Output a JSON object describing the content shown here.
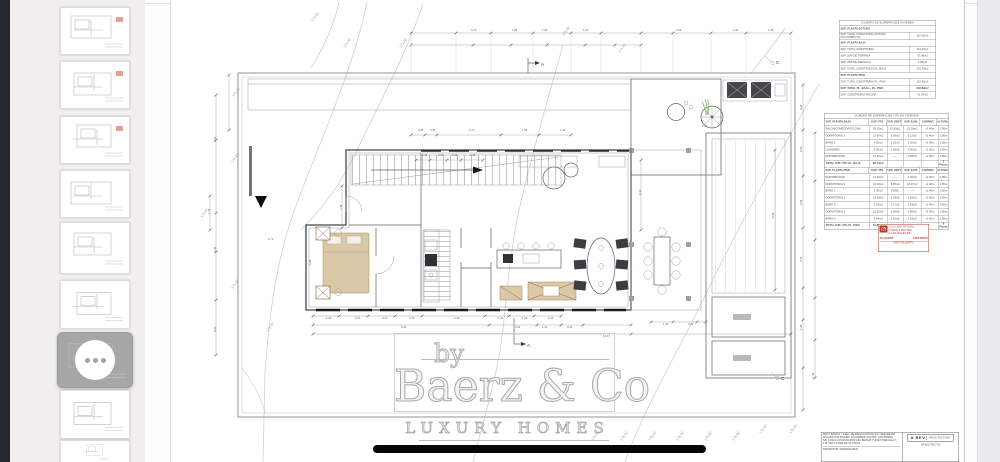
{
  "sidebar": {
    "pages": [
      {
        "selected": false
      },
      {
        "selected": false
      },
      {
        "selected": false
      },
      {
        "selected": false
      },
      {
        "selected": false
      },
      {
        "selected": false
      },
      {
        "selected": true
      },
      {
        "selected": false
      },
      {
        "selected": false
      }
    ]
  },
  "watermark": {
    "by": "by",
    "brand": "Baerz & Co",
    "tagline": "LUXURY HOMES"
  },
  "tables": {
    "superficies": {
      "title": "CUADRO DE SUPERFICIES VIVIENDA",
      "rows": [
        {
          "type": "head",
          "label": "SUP. PLANTA SOTANO"
        },
        {
          "type": "row",
          "label": "SUP. TOTAL CONSTRUIDA SOTANO\n(NO COMPUTA)",
          "value": "110.50m2"
        },
        {
          "type": "head",
          "label": "SUP. PLANTA BAJA"
        },
        {
          "type": "row",
          "label": "SUP. TOTAL CONSTRUIDA",
          "value": "113.40m2"
        },
        {
          "type": "row",
          "label": "SUP. 50% DE TERRAZA",
          "value": "17.06m2"
        },
        {
          "type": "row",
          "label": "SUP. 25% DE PERGOLA",
          "value": "1.88m2"
        },
        {
          "type": "row",
          "label": "SUP. TOTAL CONSTRUIDA PL. BAJA",
          "value": "132.34m2"
        },
        {
          "type": "head",
          "label": "SUP. PLANTA PISO"
        },
        {
          "type": "row",
          "label": "SUP. TOTAL CONSTRUIDA PL. PISO",
          "value": "110.55m2"
        },
        {
          "type": "row",
          "label": "SUP. TOTAL PL. BAJA + PL. PISO",
          "value": "242.89m2",
          "bold": true
        },
        {
          "type": "row",
          "label": "SUP. CONSTRUIDA PISCINA",
          "value": "41.78m2"
        }
      ]
    },
    "utiles": {
      "title": "CUADRO DE SUPERFICIES ÚTILES VIVIENDA",
      "sections": [
        {
          "header": [
            "SUP. PLANTA BAJA",
            "SUP. ÚTIL",
            "SUP. VENT",
            "SUP. ILUM",
            "CARPINT.",
            "ALTURA"
          ],
          "rows": [
            [
              "SALON/COMEDOR/COCINA",
              "55.15m2",
              "13.83m2",
              "23.05m2",
              "+2.40m",
              "2.85m"
            ],
            [
              "DORMITORIO 1",
              "12.87m2",
              "3.06m2",
              "6.12m2",
              "+2.40m",
              "2.85m"
            ],
            [
              "BAÑO 1",
              "4.25m2",
              "1.02m2",
              "1.02m2",
              "+1.40m",
              "2.85m"
            ],
            [
              "LAVADERO",
              "5.35m2",
              "2.45m2",
              "4.90m2",
              "+1.05m",
              "2.85m"
            ],
            [
              "DISTRIBUIDOR",
              "10.52m2",
              "-----",
              "4.06m2",
              "+1.05m",
              "2.85m"
            ]
          ],
          "total": {
            "label": "TOTAL SUP. ÚTIL PL. BAJA",
            "value": "88.14m2",
            "note": "3 Piezas"
          }
        },
        {
          "header": [
            "SUP. PLANTA PISO",
            "SUP. ÚTIL",
            "SUP. VENT",
            "SUP. ILUM",
            "CARPINT.",
            "ALTURA"
          ],
          "rows": [
            [
              "DISTRIBUIDOR",
              "12.40m2",
              "------",
              "4.36m2",
              "+1.20m",
              "2.85m"
            ],
            [
              "DORMITORIO 2",
              "24.36m2",
              "8.05m2",
              "16.07m2",
              "+2.40m",
              "2.85m"
            ],
            [
              "BAÑO 2",
              "5.36m2",
              "FORZ.",
              "------",
              "+1.40m",
              "2.85m"
            ],
            [
              "DORMITORIO 3",
              "13.39m2",
              "2.34m2",
              "3.84m2",
              "+2.40m",
              "2.85m"
            ],
            [
              "BAÑO 3",
              "5.03m2",
              "1.17m2",
              "1.63m2",
              "+1.40m",
              "2.85m"
            ],
            [
              "DORMITORIO 4",
              "16.25m2",
              "2.46m2",
              "4.85m2",
              "+2.40m",
              "2.85m"
            ],
            [
              "BAÑO 4",
              "5.04m2",
              "1.15m2",
              "1.63m2",
              "+1.40m",
              "2.85m"
            ]
          ],
          "total": {
            "label": "TOTAL SUP. ÚTIL PL. PISO",
            "value": "81.83m2",
            "note": "6 Piezas"
          }
        }
      ]
    }
  },
  "stamp": {
    "org_line1": "COL·LEGI OFICIAL",
    "org_line2": "D'ARQUITECTES",
    "org_line3": "ILLES BALEARS",
    "date": "13.10.2023",
    "number": "12614/2023",
    "footer": "VISAT TELEMÀTIC"
  },
  "title_block": {
    "lines": [
      "PROY. BASICO Y EJEC. DE AMPLIACION DE VIV. UNIFAMILIAR",
      "AISLADA CON PISCINA, EN CARRER GROSUT, CAN RIMBAU,",
      "S/N, FINCA CONOCIDA POR CAN BERNAT TUNIET (PARCELA 2)",
      "T.M. SANT JOSEP DE SA TALAIA"
    ],
    "promotor": "PROMOTOR:   PEDRAM MIUN",
    "firm_name": "A REV",
    "firm_suffix": "ARCHITECTURE",
    "role": "ARQUITECTO"
  },
  "drawing": {
    "dim_labels": [
      {
        "t": "4.70",
        "x": 300,
        "y": 31
      },
      {
        "t": "1.86",
        "x": 341,
        "y": 31
      },
      {
        "t": "1.90",
        "x": 371,
        "y": 31
      },
      {
        "t": "2.40",
        "x": 412,
        "y": 31
      },
      {
        "t": "4.35",
        "x": 505,
        "y": 31
      },
      {
        "t": "2.44",
        "x": 562,
        "y": 31
      },
      {
        "t": "1.35",
        "x": 597,
        "y": 31
      },
      {
        "t": "0.45",
        "x": 247,
        "y": 131
      },
      {
        "t": "0.45",
        "x": 259,
        "y": 131
      },
      {
        "t": "4.70",
        "x": 298,
        "y": 131
      },
      {
        "t": "1.95",
        "x": 351,
        "y": 131
      },
      {
        "t": "1.45",
        "x": 389,
        "y": 131
      },
      {
        "t": "2.40",
        "x": 251,
        "y": 156
      },
      {
        "t": "2.40",
        "x": 267,
        "y": 156
      },
      {
        "t": "0.45",
        "x": 281,
        "y": 156
      },
      {
        "t": "2.45",
        "x": 299,
        "y": 156
      },
      {
        "t": "2.44",
        "x": 531,
        "y": 127
      },
      {
        "t": "1.00",
        "x": 155,
        "y": 319
      },
      {
        "t": "0.70",
        "x": 184,
        "y": 319
      },
      {
        "t": "0.70",
        "x": 211,
        "y": 319
      },
      {
        "t": "0.70",
        "x": 238,
        "y": 319
      },
      {
        "t": "2.33",
        "x": 283,
        "y": 319
      },
      {
        "t": "1.10",
        "x": 327,
        "y": 319
      },
      {
        "t": "1.00",
        "x": 351,
        "y": 319
      },
      {
        "t": "0.44",
        "x": 377,
        "y": 319
      },
      {
        "t": "9.20",
        "x": 230,
        "y": 328
      },
      {
        "t": "3.30",
        "x": 344,
        "y": 328
      },
      {
        "t": "1.40",
        "x": 371,
        "y": 328
      },
      {
        "t": "0.35",
        "x": 396,
        "y": 328
      },
      {
        "t": "14.47",
        "x": 432,
        "y": 337
      },
      {
        "t": "1.40",
        "x": 492,
        "y": 325
      },
      {
        "t": "2.43",
        "x": 517,
        "y": 325
      },
      {
        "t": "1.74",
        "x": 97,
        "y": 240
      },
      {
        "t": "3.30",
        "x": 45,
        "y": 142,
        "r": -90
      },
      {
        "t": "1.20",
        "x": 39,
        "y": 214,
        "r": -90
      },
      {
        "t": "2.45",
        "x": 45,
        "y": 252,
        "r": -90
      },
      {
        "t": "6.30",
        "x": 45,
        "y": 332,
        "r": -90
      },
      {
        "t": "1.36",
        "x": 171,
        "y": 210,
        "r": -90
      },
      {
        "t": "3.58",
        "x": 140,
        "y": 265,
        "r": -90
      },
      {
        "t": "4.35",
        "x": 631,
        "y": 110,
        "r": -90
      },
      {
        "t": "0.35",
        "x": 631,
        "y": 152,
        "r": -90
      },
      {
        "t": "2.50",
        "x": 631,
        "y": 205,
        "r": -90
      },
      {
        "t": "2.75",
        "x": 631,
        "y": 262,
        "r": -90
      },
      {
        "t": "1.35",
        "x": 631,
        "y": 330,
        "r": -90
      },
      {
        "t": "1.45",
        "x": 643,
        "y": 378,
        "r": -90
      },
      {
        "t": "4.30",
        "x": 470,
        "y": 195,
        "r": -90
      },
      {
        "t": "6.30",
        "x": 603,
        "y": 218,
        "r": -90
      }
    ],
    "elevation_labels": [
      {
        "t": "174.00",
        "x": 142,
        "y": 22
      },
      {
        "t": "175.20",
        "x": 174,
        "y": 48
      },
      {
        "t": "175.40",
        "x": 230,
        "y": 48
      },
      {
        "t": "175.80",
        "x": 393,
        "y": 36
      },
      {
        "t": "175.20",
        "x": 449,
        "y": 53
      },
      {
        "t": "175.40",
        "x": 63,
        "y": 97
      },
      {
        "t": "175.40",
        "x": 62,
        "y": 163
      },
      {
        "t": "173.40",
        "x": 31,
        "y": 218
      },
      {
        "t": "175.20",
        "x": 62,
        "y": 289
      },
      {
        "t": "175.00",
        "x": 97,
        "y": 332
      },
      {
        "t": "175.40",
        "x": 422,
        "y": 441
      },
      {
        "t": "176.20",
        "x": 451,
        "y": 441
      },
      {
        "t": "176.20",
        "x": 479,
        "y": 441
      },
      {
        "t": "176.40",
        "x": 507,
        "y": 441
      },
      {
        "t": "176.60",
        "x": 535,
        "y": 441
      },
      {
        "t": "176.80",
        "x": 563,
        "y": 441
      },
      {
        "t": "175.40",
        "x": 590,
        "y": 434
      },
      {
        "t": "176.40",
        "x": 620,
        "y": 434
      }
    ],
    "section_markers": [
      {
        "t": "A",
        "x": 370,
        "y": 66
      },
      {
        "t": "A",
        "x": 356,
        "y": 347
      },
      {
        "t": "C",
        "x": 605,
        "y": 64
      },
      {
        "t": "C",
        "x": 610,
        "y": 380
      }
    ]
  }
}
